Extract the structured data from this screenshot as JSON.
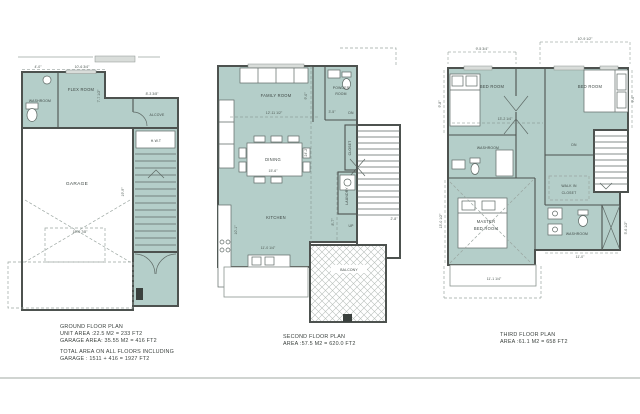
{
  "document": {
    "type": "architectural-floor-plan-sheet",
    "colors": {
      "background": "#ffffff",
      "room_fill": "#b4cec9",
      "wall": "#4d524f",
      "dimension_text": "#4e5954",
      "footer_rule": "#d0d4d1"
    }
  },
  "ground_floor": {
    "rooms": {
      "washroom": "WASHROOM",
      "flex_room": "FLEX ROOM",
      "alcove": "ALCOVE",
      "garage": "GARAGE",
      "hwt": "H.W.T"
    },
    "dims": {
      "top_left": "4'-0\"",
      "top": "10'-6 3/4\"",
      "flex_height": "7'-7 1/2\"",
      "alcove_width": "8'-3 3/8\"",
      "garage_depth": "19'-9\"",
      "garage_width": "18'-6 7/8\""
    },
    "caption": {
      "title": "GROUND FLOOR PLAN",
      "unit_area": "UNIT AREA :22.5 M2 = 233 FT2",
      "garage_area": "GARAGE AREA: 35.55 M2 = 416 FT2",
      "total_1": "TOTAL AREA ON ALL FLOORS INCLUDING",
      "total_2": "GARAGE : 1511 + 416 = 1927 FT2"
    }
  },
  "second_floor": {
    "rooms": {
      "family_room": "FAMILY ROOM",
      "powder_line1": "POWDER",
      "powder_line2": "ROOM",
      "dining": "DINING",
      "closet": "CLOSET",
      "laundry": "LAUNDRY",
      "kitchen": "KITCHEN",
      "balcony": "BALCONY"
    },
    "dims": {
      "family_width": "12'-11 1/2\"",
      "upper_height": "9'-0\"",
      "hall_width": "3'-5\"",
      "dn": "DN",
      "total_height": "24'-2\"",
      "dining_width": "15'-6\"",
      "kitchen_height": "10'-1\"",
      "kitchen_width": "11'-0 1/4\"",
      "up": "UP",
      "stair_run": "8'-7\"",
      "stair_width": "2'-8\""
    },
    "caption": {
      "title": "SECOND FLOOR PLAN",
      "area": "AREA :57.5 M2 = 620.0 FT2"
    }
  },
  "third_floor": {
    "rooms": {
      "bedroom_left": "BED ROOM",
      "bedroom_right": "BED ROOM",
      "washroom_upper": "WASHROOM",
      "walk_in_line1": "WALK IN",
      "walk_in_line2": "CLOSET",
      "master_line1": "MASTER",
      "master_line2": "BED ROOM",
      "washroom_lower": "WASHROOM"
    },
    "dims": {
      "top_left": "9'-5 3/4\"",
      "top_right": "10'-9 1/2\"",
      "left_height": "9'-8\"",
      "right_height": "9'-0\"",
      "bedrooms_width": "13'-2 1/4\"",
      "dn": "DN",
      "master_height": "13'-0 1/2\"",
      "master_width": "11'-1 1/4\"",
      "washroom_width": "11'-0\"",
      "washroom_height": "5'-6 1/2\""
    },
    "caption": {
      "title": "THIRD FLOOR PLAN",
      "area": "AREA :61.1 M2 = 658 FT2"
    }
  }
}
